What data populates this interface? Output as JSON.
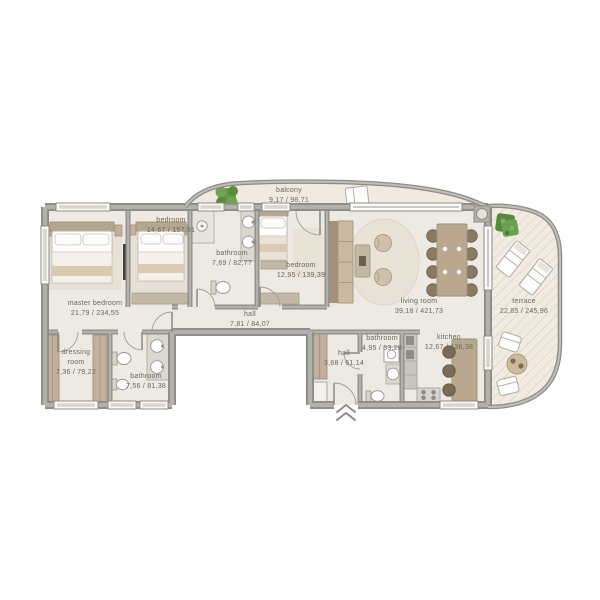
{
  "rooms": {
    "balcony": {
      "name": "balcony",
      "area": "9,17 / 98,71"
    },
    "bedroom_left": {
      "name": "bedroom",
      "area": "14,67 / 157,91"
    },
    "bathroom_top": {
      "name": "bathroom",
      "area": "7,69 / 82,77"
    },
    "bedroom_mid": {
      "name": "bedroom",
      "area": "12,95 / 139,39"
    },
    "master_bedroom": {
      "name": "master bedroom",
      "area": "21,79 / 234,55"
    },
    "hall_main": {
      "name": "hall",
      "area": "7,81 / 84,07"
    },
    "living_room": {
      "name": "living room",
      "area": "39,18 / 421,73"
    },
    "terrace": {
      "name": "terrace",
      "area": "22,85 / 245,96"
    },
    "dressing_room": {
      "name": "dressing room",
      "area": "7,36 / 79,22"
    },
    "bathroom_left": {
      "name": "bathroom",
      "area": "7,56 / 81,38"
    },
    "hall_entry": {
      "name": "hall",
      "area": "3,68 / 61,14"
    },
    "bathroom_entry": {
      "name": "bathroom",
      "area": "4,95 / 53,28"
    },
    "kitchen": {
      "name": "kitchen",
      "area": "12,67 / 136,38"
    }
  },
  "icons": {
    "entrance_marker": "double-chevron-up"
  },
  "colors": {
    "wall": "#8e8c87",
    "wall_light": "#b3b1ac",
    "floor_indoor": "#edeae3",
    "floor_outdoor": "#f0eae1",
    "hatch": "#dcd1c1",
    "wood": "#b9a88f",
    "wood_dark": "#7b6b57",
    "plant_green": "#5d9140",
    "label_text": "#6b665e"
  }
}
